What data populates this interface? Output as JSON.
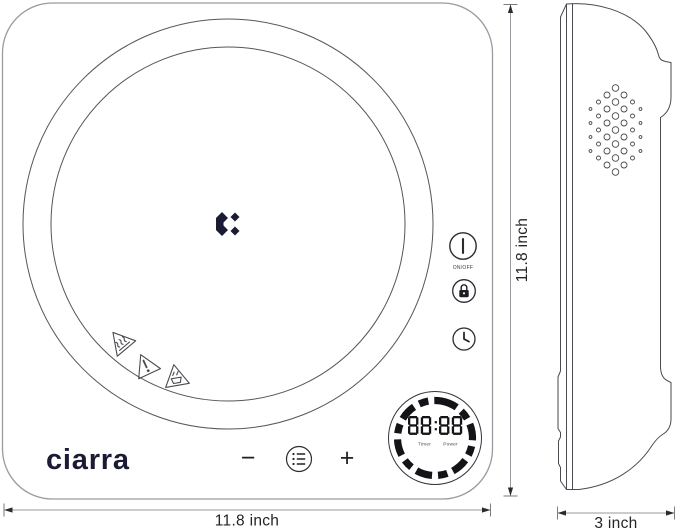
{
  "colors": {
    "ink": "#1b1b33",
    "line": "#55555c",
    "outline": "#9a9aa0",
    "dimension": "#98989e",
    "control": "#2b2b30",
    "display": "#131318"
  },
  "brand": {
    "wordmark": "ciarra"
  },
  "front_view": {
    "power_button": {
      "label": "ON/OFF"
    },
    "display": {
      "value": "88:88",
      "left_label": "Timer",
      "right_label": "Power"
    },
    "minus_label": "−",
    "plus_label": "+"
  },
  "dimensions": {
    "front_width": "11.8 inch",
    "front_height": "11.8 inch",
    "side_depth": "3 inch"
  }
}
